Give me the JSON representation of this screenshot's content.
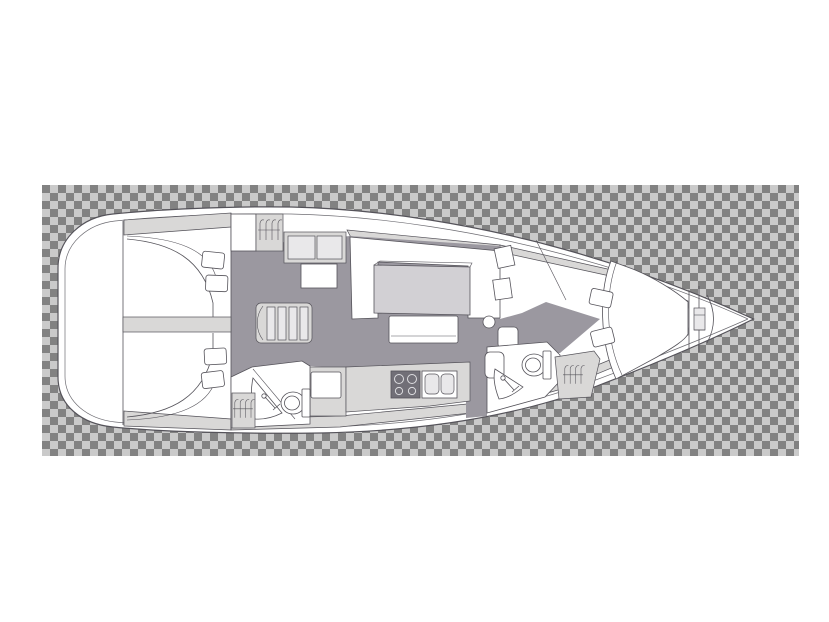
{
  "meta": {
    "title": "Sailing yacht interior layout floor plan on transparency checkerboard",
    "canvas": {
      "width": 829,
      "height": 622
    }
  },
  "colors": {
    "page_bg": "#ffffff",
    "checker_light": "#cacaca",
    "checker_dark": "#828282",
    "hull": "#ffffff",
    "line": "#55535a",
    "deck": "#d9d8d7",
    "floor": "#9b98a0",
    "panel": "#e9e8ea",
    "table": "#d2d0d4",
    "stove": "#716f77",
    "burner": "#dddde0"
  },
  "checkerboard": {
    "x": 42,
    "y": 185,
    "width": 757,
    "height": 271,
    "square": 8,
    "tile": 16
  },
  "features": [
    "hull-outline",
    "transparency-checkerboard",
    "stern-platform",
    "aft-cabin-port-double-berth",
    "aft-cabin-starboard-double-berth",
    "companionway-stairs",
    "hanging-lockers",
    "storage-cabinet",
    "deck-hatch",
    "salon-u-settee",
    "salon-table",
    "salon-bench",
    "stool",
    "galley-stove",
    "galley-double-sink",
    "top-loading-fridge",
    "aft-head-toilet",
    "aft-head-shower",
    "forward-head-toilet",
    "forward-head-shower",
    "washbasin",
    "bow-v-berth",
    "pillows",
    "anchor-locker",
    "windlass"
  ]
}
